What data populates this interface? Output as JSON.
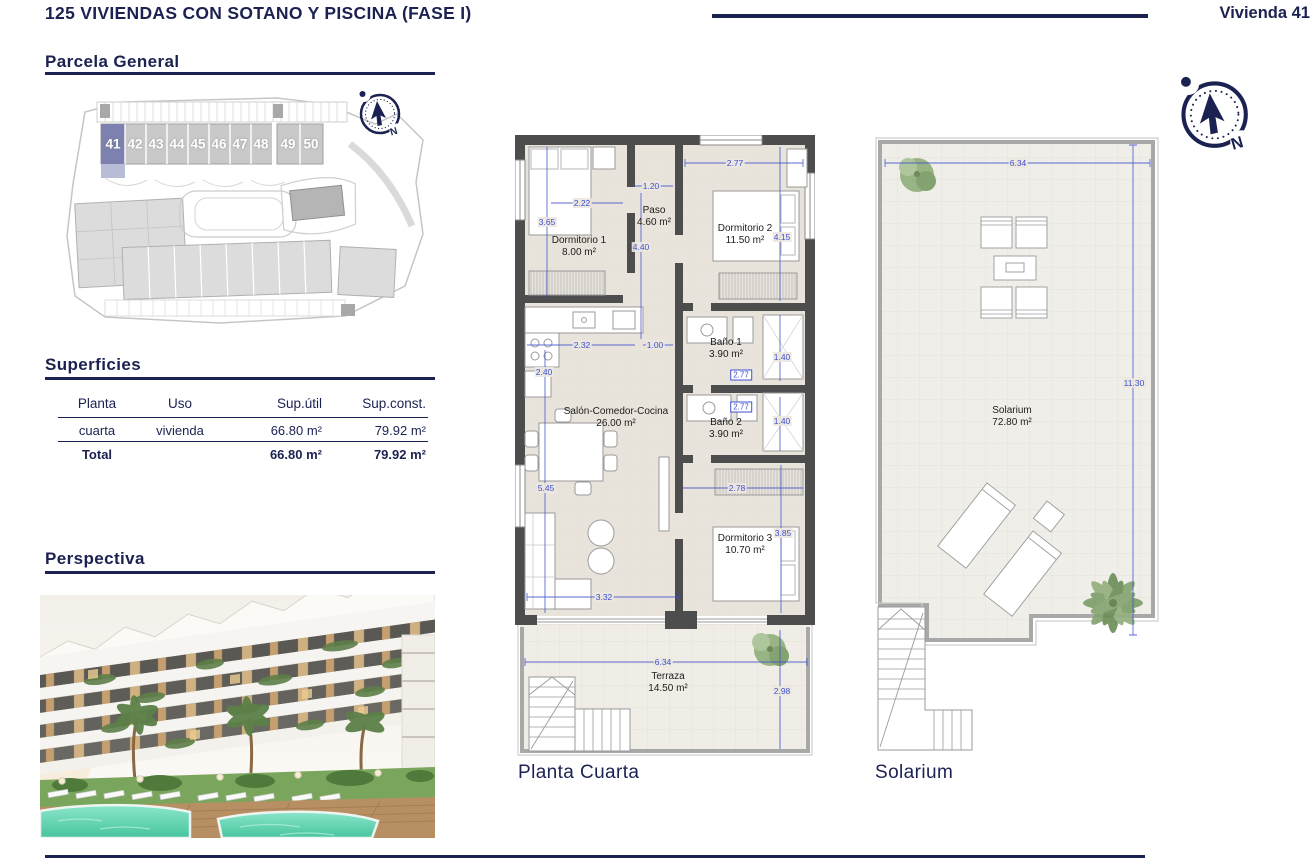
{
  "header": {
    "title": "125 VIVIENDAS CON SOTANO Y PISCINA (FASE I)",
    "vivienda": "Vivienda 41"
  },
  "sections": {
    "parcela": "Parcela General",
    "superficies": "Superficies",
    "perspectiva": "Perspectiva"
  },
  "compass": {
    "north": "N"
  },
  "site_plan": {
    "units": [
      "41",
      "42",
      "43",
      "44",
      "45",
      "46",
      "47",
      "48",
      "49",
      "50"
    ],
    "highlighted_unit": "41"
  },
  "table": {
    "headers": [
      "Planta",
      "Uso",
      "Sup.útil",
      "Sup.const."
    ],
    "rows": [
      [
        "cuarta",
        "vivienda",
        "66.80 m²",
        "79.92 m²"
      ]
    ],
    "total": [
      "Total",
      "",
      "66.80 m²",
      "79.92 m²"
    ]
  },
  "floorplan": {
    "caption": "Planta Cuarta",
    "rooms": [
      {
        "name": "Dormitorio 1",
        "area": "8.00 m²"
      },
      {
        "name": "Paso",
        "area": "4.60 m²"
      },
      {
        "name": "Dormitorio 2",
        "area": "11.50 m²"
      },
      {
        "name": "Baño 1",
        "area": "3.90 m²"
      },
      {
        "name": "Baño 2",
        "area": "3.90 m²"
      },
      {
        "name": "Salón-Comedor-Cocina",
        "area": "26.00 m²"
      },
      {
        "name": "Dormitorio 3",
        "area": "10.70 m²"
      },
      {
        "name": "Terraza",
        "area": "14.50 m²"
      }
    ],
    "dims": [
      "3.65",
      "2.22",
      "1.20",
      "4.40",
      "2.77",
      "4.15",
      "2.32",
      "1.00",
      "2.40",
      "2.77",
      "1.40",
      "2.77",
      "1.40",
      "5.45",
      "2.78",
      "3.85",
      "3.32",
      "6.34",
      "2.98"
    ]
  },
  "solarium": {
    "caption": "Solarium",
    "name": "Solarium",
    "area": "72.80 m²",
    "dims": [
      "6.34",
      "11.30"
    ]
  },
  "colors": {
    "navy": "#1b2150",
    "dimension_blue": "#3f51cc",
    "wall_gray": "#4d4d4d",
    "unit_highlight": "#7c81af",
    "pool_teal": "#5fd4b0",
    "floor_beige": "#e9e4db"
  }
}
